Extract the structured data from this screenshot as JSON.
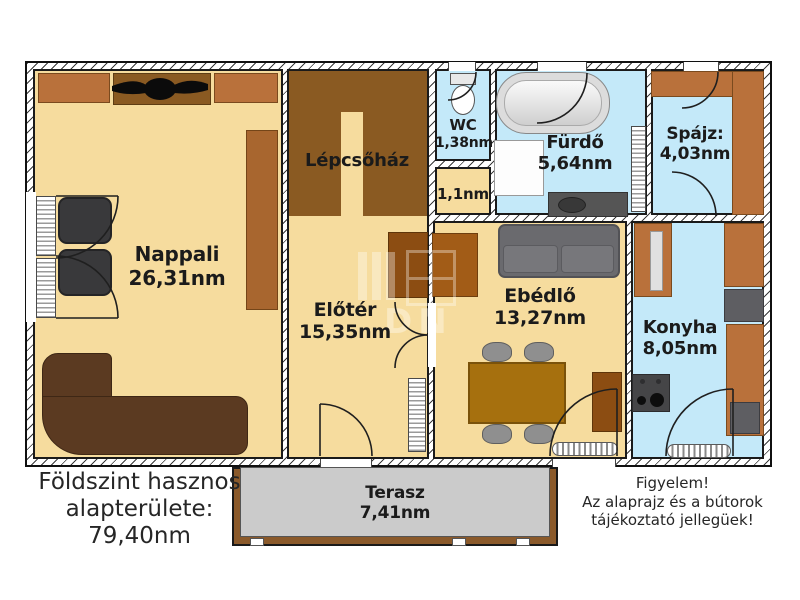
{
  "rooms": {
    "nappali": {
      "label": "Nappali",
      "area": "26,31nm"
    },
    "lepcsohaz": {
      "label": "Lépcsőház"
    },
    "wc": {
      "label": "WC",
      "area": "1,38nm"
    },
    "kisterulet": {
      "area": "1,1nm"
    },
    "furdo": {
      "label": "Fürdő",
      "area": "5,64nm"
    },
    "spajz": {
      "label": "Spájz:",
      "area": "4,03nm"
    },
    "eloter": {
      "label": "Előtér",
      "area": "15,35nm"
    },
    "ebedlo": {
      "label": "Ebédlő",
      "area": "13,27nm"
    },
    "konyha": {
      "label": "Konyha",
      "area": "8,05nm"
    },
    "terasz": {
      "label": "Terasz",
      "area": "7,41nm"
    }
  },
  "notes": {
    "area_summary": [
      "Földszint hasznos",
      "alapterülete:",
      "79,40nm"
    ],
    "disclaimer": [
      "Figyelem!",
      "Az alaprajz és a bútorok",
      "tájékoztató jellegüek!"
    ]
  },
  "watermark": "DN",
  "palette": {
    "floor_tan": "#F6DC9E",
    "floor_blue": "#C4E9F9",
    "stairs_brown": "#8A5A22",
    "furniture_brown": "#B9713B",
    "dark_cabinet_brown": "#8C4D12",
    "terrace_gray": "#CBCBCB",
    "terrace_frame_brown": "#8B5A2B",
    "wall_color": "#1A1A1A"
  }
}
